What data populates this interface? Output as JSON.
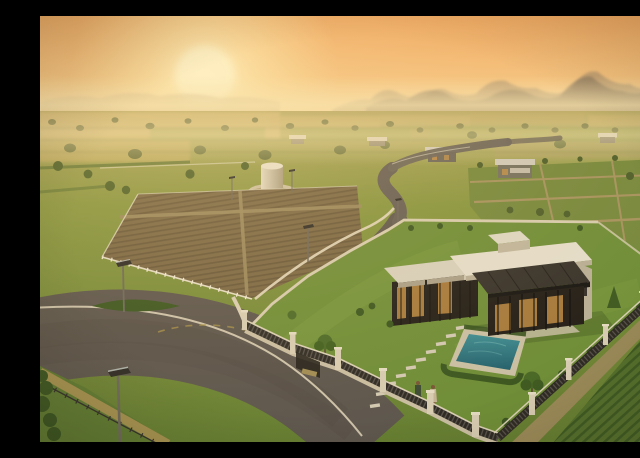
{
  "scene": {
    "description": "Aerial 3D render at sunset: fenced farmland plots, a winding road, a modern flat-roof villa with swimming pool, and a couple walking on the lawn, with hazy mountains behind",
    "objects": [
      "setting-sun",
      "mountain-range",
      "morning-haze",
      "distant-farmland",
      "plowed-plots",
      "gridded-green-plots",
      "water-tank",
      "winding-road",
      "main-road-junction",
      "boundary-walls",
      "picket-fences",
      "street-lamps",
      "modern-villa",
      "pergola",
      "glass-facade",
      "dark-sloped-sunroom-roof",
      "rooftop-bulkhead",
      "patio",
      "swimming-pool",
      "stepping-stones",
      "garden-trees",
      "hedges",
      "couple-walking",
      "crop-rows-field",
      "dirt-path"
    ],
    "people_count": 2,
    "people": [
      {
        "label": "man-walking",
        "appearance": "dark green jacket, dark trousers"
      },
      {
        "label": "woman-walking",
        "appearance": "light beige dress"
      }
    ]
  },
  "colors": {
    "sky_top": "#eda55e",
    "sky_mid": "#f4c27e",
    "sky_horizon": "#f9e6b2",
    "sun_glow": "#fff3c8",
    "sun_core": "#fdf4cf",
    "ridge_left": "#ab9372",
    "mountain_far": "#9b8568",
    "mountain_near": "#7e6c55",
    "haze": "#f6e3ae",
    "ground_distant": "#b3a55f",
    "ground_mid": "#87953f",
    "ground_foreground": "#657e31",
    "field_gold": "#c9ae6a",
    "field_green": "#9aa050",
    "plot_brown": "#7b6845",
    "plot_brown_dark": "#69583a",
    "grid_line": "#a6925e",
    "road": "#5d564d",
    "road_distant": "#6d655a",
    "road_line": "#e8ddc2",
    "wall_cream": "#d8cdb2",
    "fence_dark": "#2f2b24",
    "pillar": "#d7ccb1",
    "lawn": "#6f8d37",
    "lawn_light": "#7f9d42",
    "hedge": "#3c5620",
    "tree": "#4c6a28",
    "tree_dark": "#3f5a22",
    "house_wall": "#d3c9b2",
    "house_wall_shadow": "#b9af96",
    "roof_slab": "#e4ddca",
    "roof_dark": "#38332b",
    "glass": "#241f18",
    "window_glow": "#c79146",
    "pool_light": "#3f8d92",
    "pool_deep": "#25606b",
    "coping": "#c9bfa2",
    "stone": "#d2c9b2",
    "dirt": "#9b8a58",
    "crop_rows": "#55702c",
    "crop_gap": "#3f5a22",
    "tank": "#cfc5ae",
    "man_jacket": "#3d4a33",
    "woman_dress": "#c4b394",
    "skin": "#7a5637",
    "lamp_pole": "#6e685c",
    "lamp_panel": "#2e2b26"
  }
}
